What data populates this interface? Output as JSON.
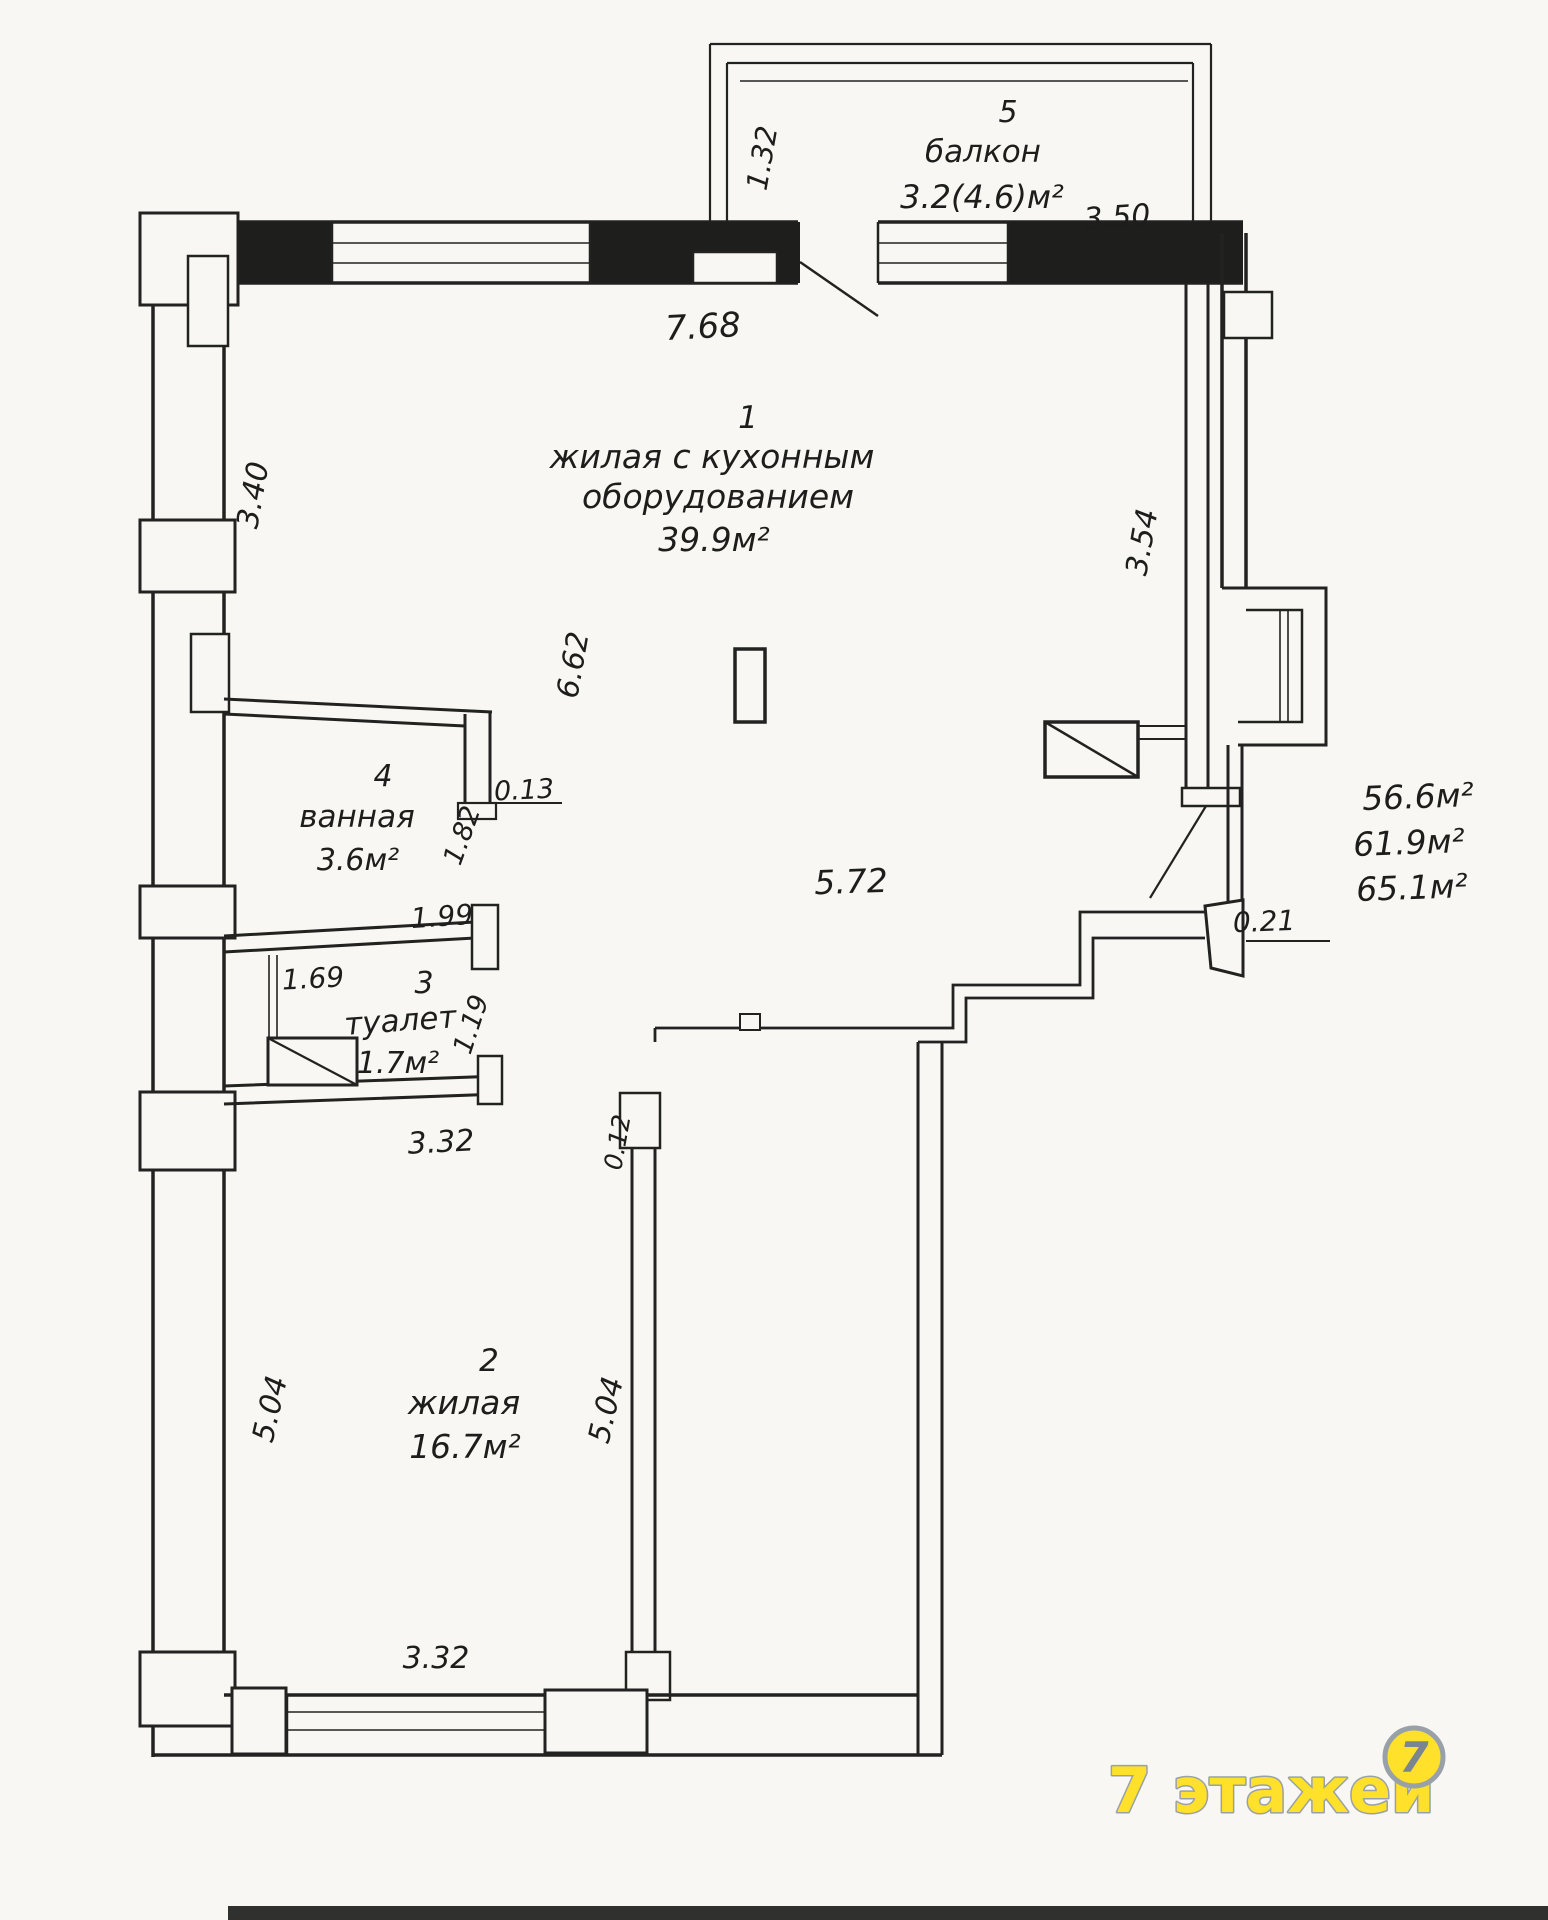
{
  "plan": {
    "rooms": {
      "r1": {
        "number": "1",
        "label_line1": "жилая с кухонным",
        "label_line2": "оборудованием",
        "area": "39.9м²"
      },
      "r2": {
        "number": "2",
        "label": "жилая",
        "area": "16.7м²"
      },
      "r3": {
        "number": "3",
        "label": "туалет",
        "area": "1.7м²"
      },
      "r4": {
        "number": "4",
        "label": "ванная",
        "area": "3.6м²"
      },
      "r5": {
        "number": "5",
        "label": "балкон",
        "area": "3.2(4.6)м²"
      }
    },
    "dims": {
      "balcony_depth": "1.32",
      "balcony_width": "3.50",
      "top_width": "7.68",
      "left_upper": "3.40",
      "right_upper": "3.54",
      "room1_height": "6.62",
      "wall_step": "0.13",
      "bath_wall": "1.82",
      "bath_width": "1.99",
      "toilet_niche": "1.69",
      "toilet_height": "1.19",
      "toilet_width": "3.32",
      "door_jamb": "0.12",
      "hall_width": "5.72",
      "entry_wall": "0.21",
      "room2_height_left": "5.04",
      "room2_height_right": "5.04",
      "room2_width": "3.32"
    },
    "area_summary": {
      "living": "56.6м²",
      "total": "61.9м²",
      "with_balcony": "65.1м²"
    }
  },
  "logo": {
    "text": "7 этажей",
    "icon_digit": "7",
    "yellow": "#FFE02A",
    "gray": "#98A1A7",
    "digit_gray": "#7A8590"
  }
}
